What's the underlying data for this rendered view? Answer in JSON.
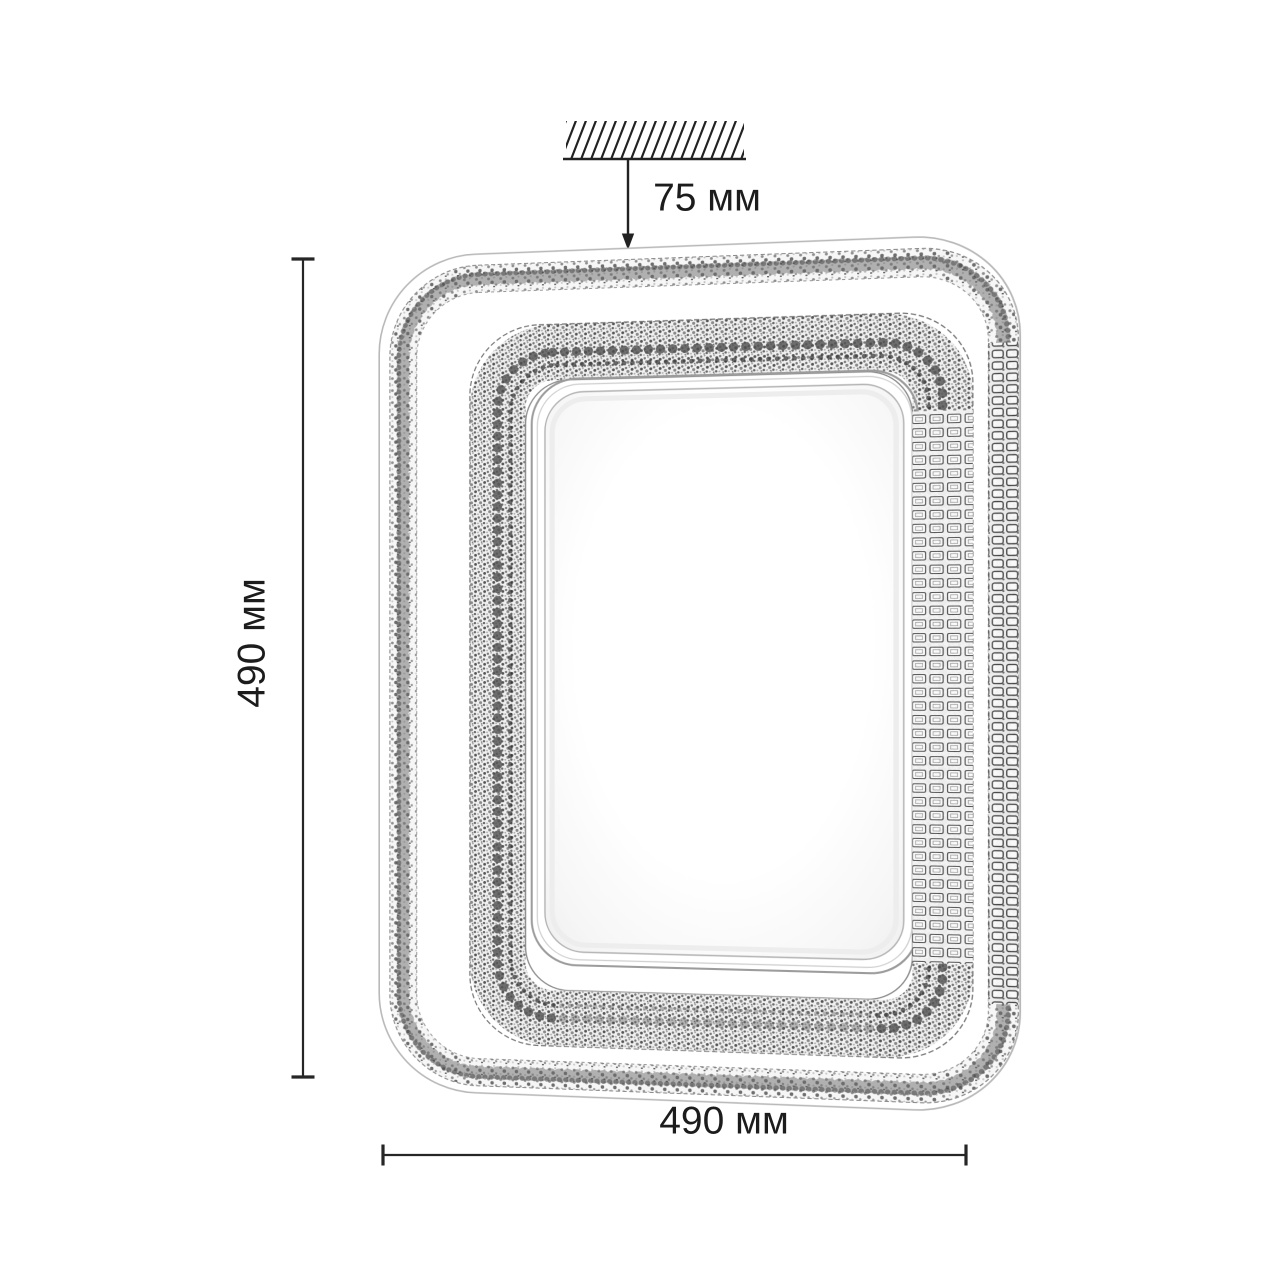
{
  "diagram": {
    "kind": "ceiling-lamp-dimension-drawing",
    "dimensions": {
      "mount_depth": "75 мм",
      "height": "490 мм",
      "width": "490 мм"
    },
    "icons": {
      "ceiling": "ceiling-hatch-icon",
      "mount_arrow": "down-arrow-icon"
    },
    "colors": {
      "background": "#ffffff",
      "dimension_line": "#262626",
      "text": "#1c1c1c",
      "lamp_outline": "#b8b8b8",
      "crystal_dark": "#4d4d4d",
      "crystal_mid": "#8a8a8a",
      "crystal_light": "#d9d9d9"
    }
  }
}
